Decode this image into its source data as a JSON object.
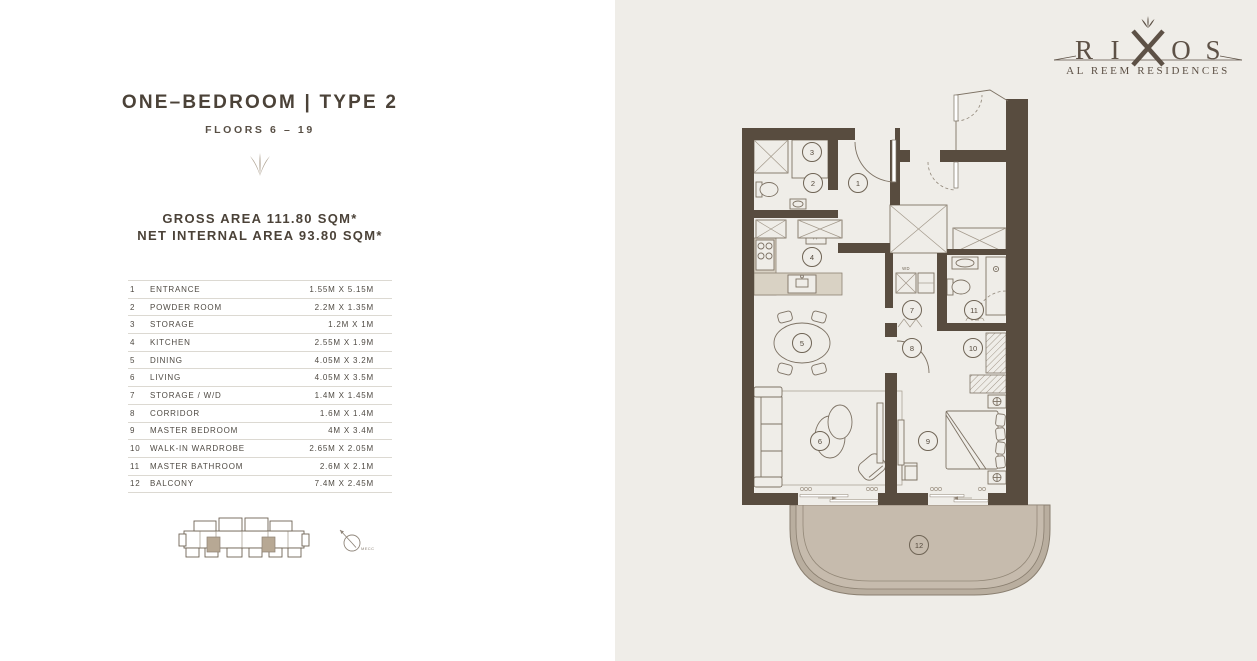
{
  "brand": {
    "letters": [
      "R",
      "I",
      "O",
      "S"
    ],
    "subtitle": "AL REEM RESIDENCES"
  },
  "unit": {
    "title": "ONE–BEDROOM | TYPE 2",
    "floors": "FLOORS 6 – 19",
    "gross_area": "GROSS AREA 111.80 SQM*",
    "net_area": "NET INTERNAL AREA 93.80 SQM*"
  },
  "rooms": [
    {
      "no": "1",
      "name": "ENTRANCE",
      "dims": "1.55M X 5.15M"
    },
    {
      "no": "2",
      "name": "POWDER ROOM",
      "dims": "2.2M X 1.35M"
    },
    {
      "no": "3",
      "name": "STORAGE",
      "dims": "1.2M X 1M"
    },
    {
      "no": "4",
      "name": "KITCHEN",
      "dims": "2.55M X 1.9M"
    },
    {
      "no": "5",
      "name": "DINING",
      "dims": "4.05M X 3.2M"
    },
    {
      "no": "6",
      "name": "LIVING",
      "dims": "4.05M X 3.5M"
    },
    {
      "no": "7",
      "name": "STORAGE / W/D",
      "dims": "1.4M X 1.45M"
    },
    {
      "no": "8",
      "name": "CORRIDOR",
      "dims": "1.6M X 1.4M"
    },
    {
      "no": "9",
      "name": "MASTER BEDROOM",
      "dims": "4M X 3.4M"
    },
    {
      "no": "10",
      "name": "WALK-IN WARDROBE",
      "dims": "2.65M X 2.05M"
    },
    {
      "no": "11",
      "name": "MASTER BATHROOM",
      "dims": "2.6M X 2.1M"
    },
    {
      "no": "12",
      "name": "BALCONY",
      "dims": "7.4M X 2.45M"
    }
  ],
  "plan_labels": {
    "fridge": "FF",
    "washer": "WD",
    "compass": "MECCA"
  },
  "colors": {
    "panel_background": "#efede8",
    "wall": "#584c3f",
    "accent_tan": "#b0a494",
    "balcony_fill": "#c2b7a9",
    "text": "#4b4238"
  }
}
